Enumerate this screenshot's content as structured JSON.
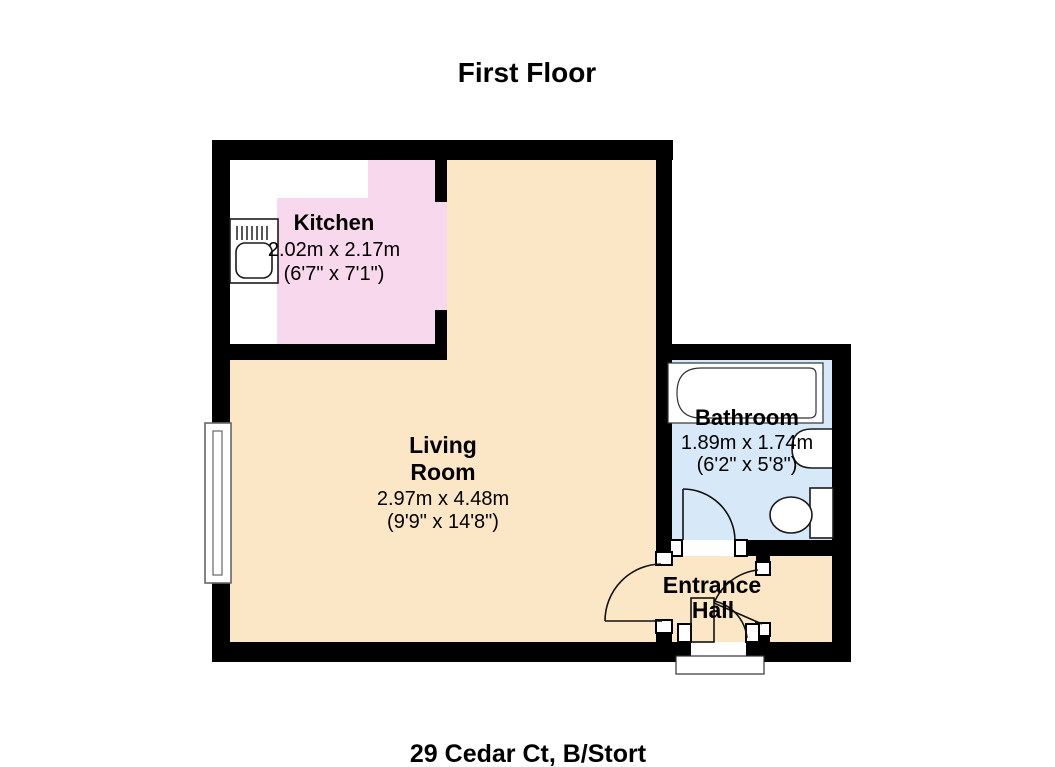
{
  "title": "First Floor",
  "address_caption": "29 Cedar Ct, B/Stort",
  "rooms": {
    "kitchen": {
      "name": "Kitchen",
      "size_metric": "2.02m x 2.17m",
      "size_imperial": "(6'7\" x 7'1\")",
      "floor_color": "#f8d8ec"
    },
    "living_room": {
      "name_line1": "Living",
      "name_line2": "Room",
      "size_metric": "2.97m x 4.48m",
      "size_imperial": "(9'9\" x 14'8\")",
      "floor_color": "#fbe7c6"
    },
    "bathroom": {
      "name": "Bathroom",
      "size_metric": "1.89m x 1.74m",
      "size_imperial": "(6'2\" x 5'8\")",
      "floor_color": "#d7e9f9"
    },
    "entrance_hall": {
      "name_line1": "Entrance",
      "name_line2": "Hall",
      "floor_color": "#fbe7c6"
    },
    "cupboard": {
      "floor_color": "#fbe7c6"
    }
  },
  "colors": {
    "background": "#ffffff",
    "wall": "#000000",
    "counter": "#ffffff",
    "fixture_fill": "#ffffff",
    "window_frame": "#666666",
    "text": "#000000"
  }
}
